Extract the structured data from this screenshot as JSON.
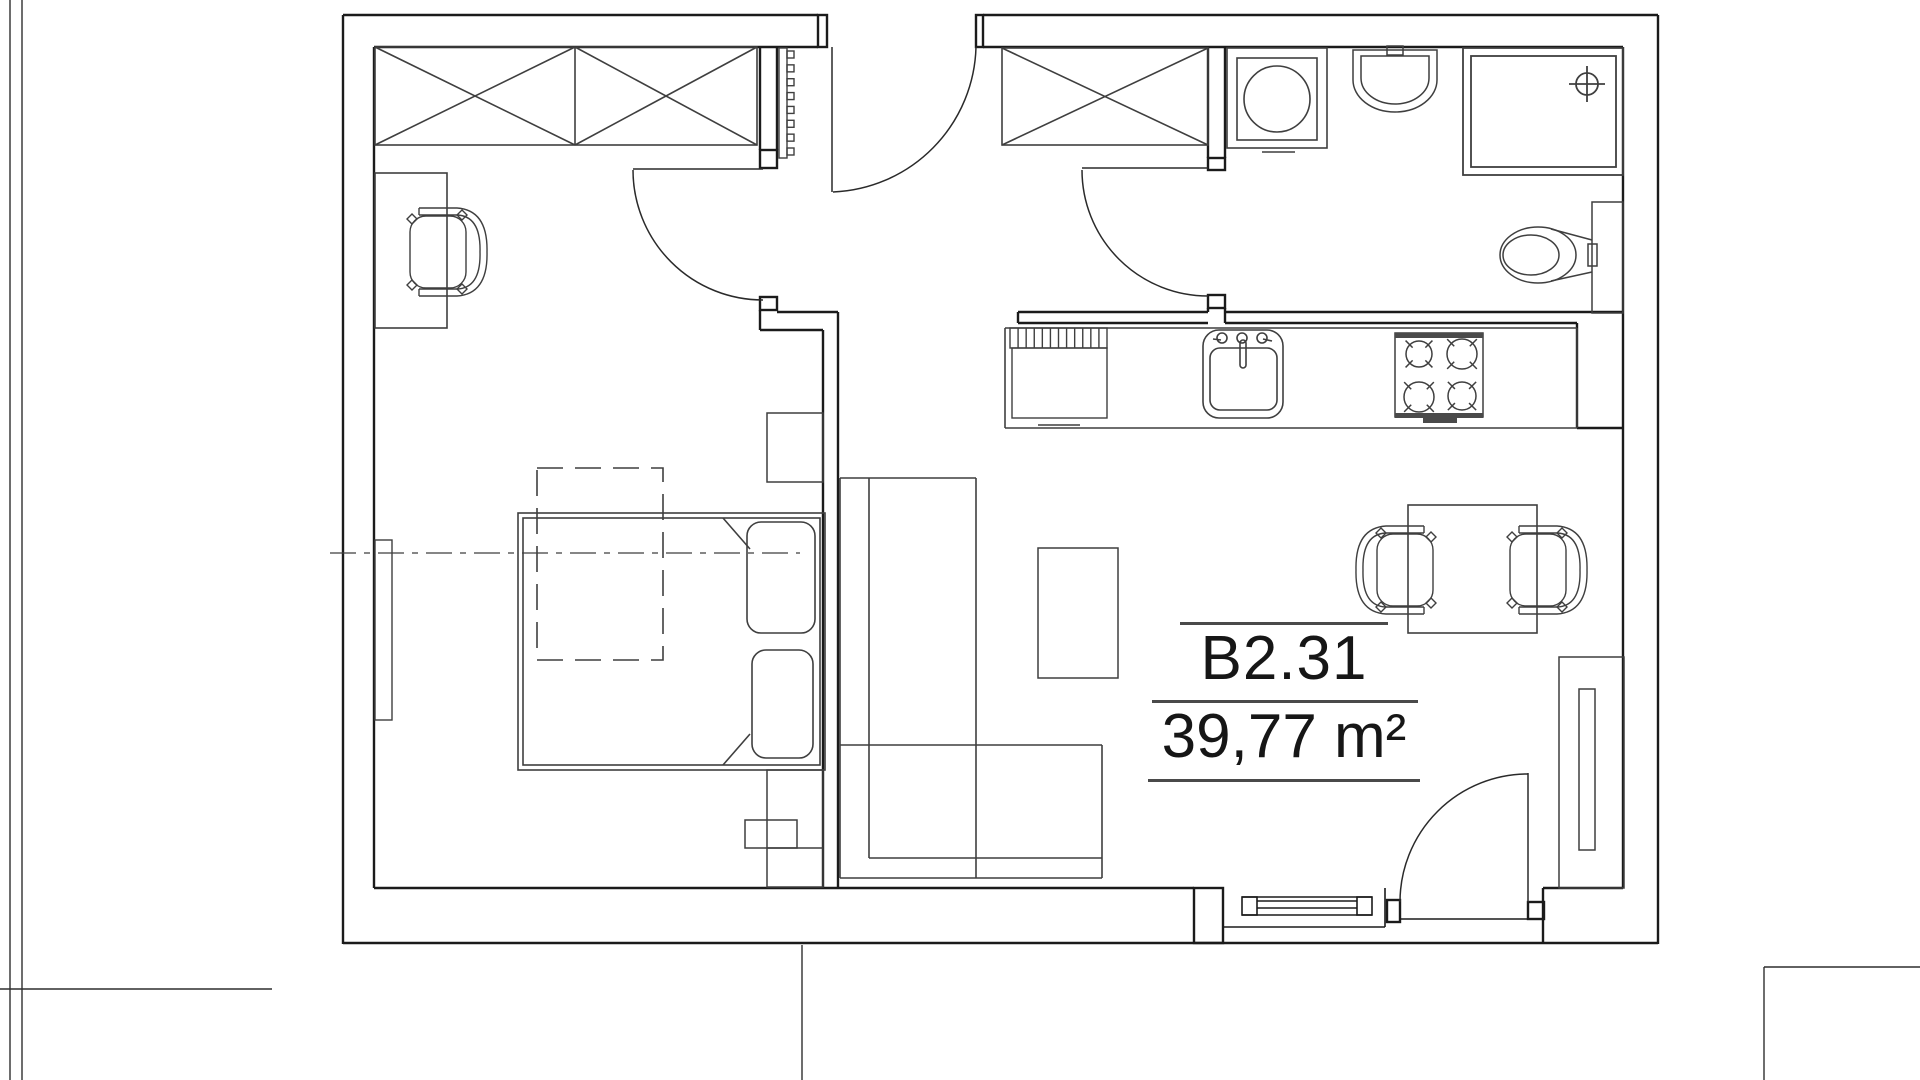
{
  "unit": {
    "label": "B2.31",
    "area": "39,77 m²"
  },
  "colors": {
    "wall": "#1b1b1b",
    "furniture": "#3f3f3f",
    "door": "#2a2a2a",
    "context": "#2f2f2f",
    "band_fill": "#4a4a4a",
    "background": "#ffffff"
  },
  "floorplan": {
    "canvas": {
      "w": 1920,
      "h": 1080
    },
    "fixtures": [
      {
        "name": "context-lines",
        "role": "site-boundary",
        "sw": 1.4,
        "stroke_key": "context",
        "lines": [
          [
            10,
            0,
            10,
            1080
          ],
          [
            22,
            0,
            22,
            1080
          ],
          [
            0,
            989,
            272,
            989
          ],
          [
            802,
            945,
            802,
            1080
          ],
          [
            1764,
            967,
            1920,
            967
          ],
          [
            1764,
            967,
            1764,
            1080
          ]
        ]
      },
      {
        "name": "walls",
        "role": "structure",
        "sw": 2.4,
        "stroke_key": "wall",
        "lines": [
          [
            343,
            15,
            818,
            15
          ],
          [
            983,
            15,
            1658,
            15
          ],
          [
            343,
            15,
            343,
            944
          ],
          [
            1658,
            15,
            1658,
            944
          ],
          [
            343,
            943,
            1658,
            943
          ],
          [
            374,
            47,
            818,
            47
          ],
          [
            983,
            47,
            1623,
            47
          ],
          [
            374,
            47,
            374,
            888
          ],
          [
            374,
            888,
            1194,
            888
          ],
          [
            1543,
            888,
            1623,
            888
          ],
          [
            1623,
            47,
            1623,
            888
          ],
          [
            760,
            47,
            760,
            150
          ],
          [
            777,
            47,
            777,
            150
          ],
          [
            760,
            310,
            760,
            330
          ],
          [
            777,
            312,
            838,
            312
          ],
          [
            760,
            330,
            823,
            330
          ],
          [
            823,
            330,
            823,
            888
          ],
          [
            838,
            312,
            838,
            888
          ],
          [
            1018,
            312,
            1208,
            312
          ],
          [
            1018,
            323,
            1208,
            323
          ],
          [
            1018,
            312,
            1018,
            323
          ],
          [
            1208,
            47,
            1208,
            158
          ],
          [
            1225,
            47,
            1225,
            158
          ],
          [
            1208,
            308,
            1208,
            312
          ],
          [
            1225,
            308,
            1225,
            323
          ],
          [
            1225,
            312,
            1623,
            312
          ],
          [
            1225,
            323,
            1577,
            323
          ],
          [
            1577,
            323,
            1577,
            428
          ],
          [
            1577,
            428,
            1623,
            428
          ],
          [
            1543,
            888,
            1543,
            943
          ]
        ],
        "rects": [
          [
            818,
            15,
            9,
            32
          ],
          [
            976,
            15,
            7,
            32
          ],
          [
            760,
            150,
            17,
            18
          ],
          [
            760,
            297,
            17,
            13
          ],
          [
            1208,
            158,
            17,
            12
          ],
          [
            1208,
            295,
            17,
            13
          ],
          [
            1194,
            888,
            29,
            55
          ],
          [
            1387,
            900,
            13,
            22
          ],
          [
            1528,
            902,
            16,
            17
          ]
        ]
      },
      {
        "name": "window-living",
        "role": "window",
        "sw": 1.6,
        "stroke_key": "wall",
        "lines": [
          [
            1242,
            897,
            1372,
            897
          ],
          [
            1242,
            915,
            1372,
            915
          ],
          [
            1257,
            901,
            1357,
            901
          ],
          [
            1257,
            908,
            1357,
            908
          ],
          [
            1223,
            927,
            1385,
            927
          ],
          [
            1385,
            888,
            1385,
            927
          ],
          [
            1400,
            919,
            1528,
            919
          ]
        ],
        "rects": [
          [
            1242,
            897,
            15,
            18
          ],
          [
            1357,
            897,
            15,
            18
          ]
        ]
      },
      {
        "name": "door-entry",
        "role": "door",
        "sw": 1.5,
        "stroke_key": "door",
        "lines": [
          [
            832,
            47,
            832,
            192
          ]
        ],
        "paths": [
          "M976,47 A149,149 0 0 1 833,192"
        ]
      },
      {
        "name": "door-bedroom",
        "role": "door",
        "sw": 1.5,
        "stroke_key": "door",
        "lines": [
          [
            633,
            169,
            763,
            169
          ]
        ],
        "paths": [
          "M633,170 A130,130 0 0 0 763,300"
        ]
      },
      {
        "name": "door-bathroom",
        "role": "door",
        "sw": 1.5,
        "stroke_key": "door",
        "lines": [
          [
            1082,
            168,
            1208,
            168
          ]
        ],
        "paths": [
          "M1082,170 A126,126 0 0 0 1208,296"
        ]
      },
      {
        "name": "door-balcony",
        "role": "door",
        "sw": 1.5,
        "stroke_key": "door",
        "lines": [
          [
            1528,
            773,
            1528,
            902
          ]
        ],
        "paths": [
          "M1400,902 A128,128 0 0 1 1528,774"
        ]
      },
      {
        "name": "wardrobe-bedroom",
        "role": "furniture",
        "sw": 1.6,
        "stroke_key": "furniture",
        "rects": [
          [
            375,
            47,
            382,
            98
          ]
        ],
        "lines": [
          [
            575,
            47,
            575,
            145
          ],
          [
            375,
            47,
            575,
            145
          ],
          [
            375,
            145,
            575,
            47
          ],
          [
            575,
            47,
            757,
            145
          ],
          [
            575,
            145,
            757,
            47
          ]
        ]
      },
      {
        "name": "closet-hall",
        "role": "furniture",
        "sw": 1.6,
        "stroke_key": "furniture",
        "rects": [
          [
            1002,
            48,
            206,
            97
          ]
        ],
        "lines": [
          [
            1002,
            48,
            1208,
            145
          ],
          [
            1002,
            145,
            1208,
            48
          ]
        ]
      },
      {
        "name": "radiator-hall",
        "role": "radiator",
        "sw": 1.4,
        "stroke_key": "furniture",
        "comb": [
          779,
          48,
          8,
          110,
          8,
          7,
          7
        ]
      },
      {
        "name": "desk",
        "role": "furniture",
        "sw": 1.6,
        "stroke_key": "furniture",
        "rects": [
          [
            375,
            173,
            72,
            155
          ]
        ]
      },
      {
        "name": "chair-desk",
        "role": "furniture",
        "sw": 1.4,
        "stroke_key": "furniture",
        "chair": [
          441,
          252,
          0
        ]
      },
      {
        "name": "bed",
        "role": "furniture",
        "sw": 1.6,
        "stroke_key": "furniture",
        "rects": [
          [
            518,
            513,
            307,
            257
          ],
          [
            523,
            518,
            297,
            247
          ],
          [
            747,
            522,
            68,
            111,
            14
          ],
          [
            752,
            650,
            61,
            108,
            14
          ]
        ],
        "lines": [
          [
            723,
            518,
            750,
            549
          ],
          [
            723,
            765,
            750,
            734
          ]
        ]
      },
      {
        "name": "nightstand-top",
        "role": "furniture",
        "sw": 1.5,
        "stroke_key": "furniture",
        "rects": [
          [
            767,
            413,
            56,
            69
          ]
        ]
      },
      {
        "name": "nightstand-bottom",
        "role": "furniture",
        "sw": 1.5,
        "stroke_key": "furniture",
        "rects": [
          [
            767,
            770,
            56,
            117
          ],
          [
            745,
            820,
            52,
            28
          ]
        ],
        "lines": [
          [
            767,
            848,
            823,
            848
          ]
        ]
      },
      {
        "name": "ceiling-void-dashed",
        "role": "annotation",
        "sw": 1.6,
        "stroke_key": "furniture",
        "dash": "26 12",
        "rects": [
          [
            537,
            468,
            126,
            192
          ]
        ]
      },
      {
        "name": "axis-centerline",
        "role": "annotation",
        "sw": 1.3,
        "stroke_key": "furniture",
        "dash": "26 8 6 8",
        "lines": [
          [
            330,
            553,
            800,
            553
          ]
        ]
      },
      {
        "name": "radiator-bedroom",
        "role": "radiator",
        "sw": 1.4,
        "stroke_key": "furniture",
        "rects": [
          [
            375,
            540,
            17,
            180
          ]
        ]
      },
      {
        "name": "sofa",
        "role": "furniture",
        "sw": 1.6,
        "stroke_key": "furniture",
        "lines": [
          [
            840,
            478,
            976,
            478
          ],
          [
            840,
            478,
            840,
            878
          ],
          [
            869,
            478,
            869,
            858
          ],
          [
            976,
            478,
            976,
            878
          ],
          [
            840,
            745,
            1102,
            745
          ],
          [
            869,
            858,
            1102,
            858
          ],
          [
            840,
            878,
            1102,
            878
          ],
          [
            1102,
            745,
            1102,
            878
          ]
        ]
      },
      {
        "name": "coffee-table",
        "role": "furniture",
        "sw": 1.5,
        "stroke_key": "furniture",
        "rects": [
          [
            1038,
            548,
            80,
            130
          ]
        ]
      },
      {
        "name": "dining-table",
        "role": "furniture",
        "sw": 1.6,
        "stroke_key": "furniture",
        "rects": [
          [
            1408,
            505,
            129,
            128
          ]
        ]
      },
      {
        "name": "chair-dining-left",
        "role": "furniture",
        "sw": 1.4,
        "stroke_key": "furniture",
        "chair": [
          1402,
          570,
          180
        ]
      },
      {
        "name": "chair-dining-right",
        "role": "furniture",
        "sw": 1.4,
        "stroke_key": "furniture",
        "chair": [
          1541,
          570,
          0
        ]
      },
      {
        "name": "radiator-living",
        "role": "radiator",
        "sw": 1.5,
        "stroke_key": "furniture",
        "rects": [
          [
            1559,
            657,
            65,
            231
          ],
          [
            1579,
            689,
            16,
            161
          ]
        ]
      },
      {
        "name": "kitchen-counter",
        "role": "kitchen",
        "sw": 1.6,
        "stroke_key": "furniture",
        "lines": [
          [
            1005,
            328,
            1005,
            428
          ],
          [
            1005,
            428,
            1577,
            428
          ],
          [
            1577,
            328,
            1577,
            428
          ],
          [
            1005,
            328,
            1577,
            328
          ]
        ]
      },
      {
        "name": "kitchen-cabinet",
        "role": "kitchen",
        "sw": 1.4,
        "stroke_key": "furniture",
        "rects": [
          [
            1010,
            328,
            97,
            20
          ],
          [
            1012,
            348,
            95,
            70
          ]
        ],
        "stripes": [
          1010,
          328,
          97,
          20,
          11
        ],
        "lines": [
          [
            1038,
            425,
            1080,
            425
          ]
        ]
      },
      {
        "name": "kitchen-sink",
        "role": "kitchen",
        "sw": 1.6,
        "stroke_key": "furniture",
        "rects": [
          [
            1203,
            330,
            80,
            88,
            16
          ],
          [
            1210,
            348,
            67,
            62,
            10
          ],
          [
            1240,
            340,
            6,
            28,
            3
          ]
        ],
        "circles": [
          [
            1222,
            338,
            5
          ],
          [
            1242,
            338,
            5
          ],
          [
            1262,
            338,
            5
          ]
        ],
        "lines": [
          [
            1213,
            339,
            1221,
            340
          ],
          [
            1263,
            339,
            1272,
            341
          ]
        ]
      },
      {
        "name": "stove",
        "role": "kitchen",
        "sw": 1.5,
        "stroke_key": "furniture",
        "rects": [
          [
            1395,
            333,
            88,
            84
          ]
        ],
        "fills": [
          [
            1395,
            333,
            88,
            5
          ],
          [
            1395,
            413,
            88,
            5
          ],
          [
            1423,
            418,
            34,
            5
          ]
        ],
        "burners": [
          [
            1419,
            354,
            13
          ],
          [
            1462,
            354,
            15
          ],
          [
            1419,
            397,
            15
          ],
          [
            1462,
            396,
            14
          ]
        ]
      },
      {
        "name": "washing-machine",
        "role": "bathroom",
        "sw": 1.6,
        "stroke_key": "furniture",
        "rects": [
          [
            1227,
            48,
            100,
            100
          ],
          [
            1237,
            58,
            80,
            82
          ]
        ],
        "circles": [
          [
            1277,
            99,
            33
          ]
        ],
        "lines": [
          [
            1262,
            152,
            1295,
            152
          ]
        ]
      },
      {
        "name": "washbasin",
        "role": "bathroom",
        "sw": 1.5,
        "stroke_key": "furniture",
        "paths": [
          "M1353,50 L1437,50 L1437,80 A42,32 0 0 1 1353,80 Z",
          "M1361,56 L1429,56 L1429,78 A34,26 0 0 1 1361,78 Z"
        ],
        "rects": [
          [
            1387,
            46,
            16,
            9
          ]
        ]
      },
      {
        "name": "shower",
        "role": "bathroom",
        "sw": 1.8,
        "stroke_key": "furniture",
        "rects": [
          [
            1463,
            48,
            160,
            127
          ],
          [
            1471,
            56,
            145,
            111
          ]
        ],
        "circles": [
          [
            1587,
            84,
            11
          ]
        ],
        "lines": [
          [
            1587,
            66,
            1587,
            102
          ],
          [
            1569,
            84,
            1605,
            84
          ]
        ]
      },
      {
        "name": "toilet",
        "role": "bathroom",
        "sw": 1.5,
        "stroke_key": "furniture",
        "rects": [
          [
            1592,
            202,
            31,
            111
          ],
          [
            1588,
            244,
            9,
            22
          ]
        ],
        "ellipses": [
          [
            1538,
            255,
            38,
            28
          ],
          [
            1531,
            255,
            28,
            20
          ]
        ],
        "lines": [
          [
            1551,
            229,
            1592,
            240
          ],
          [
            1551,
            281,
            1592,
            272
          ]
        ]
      }
    ]
  }
}
